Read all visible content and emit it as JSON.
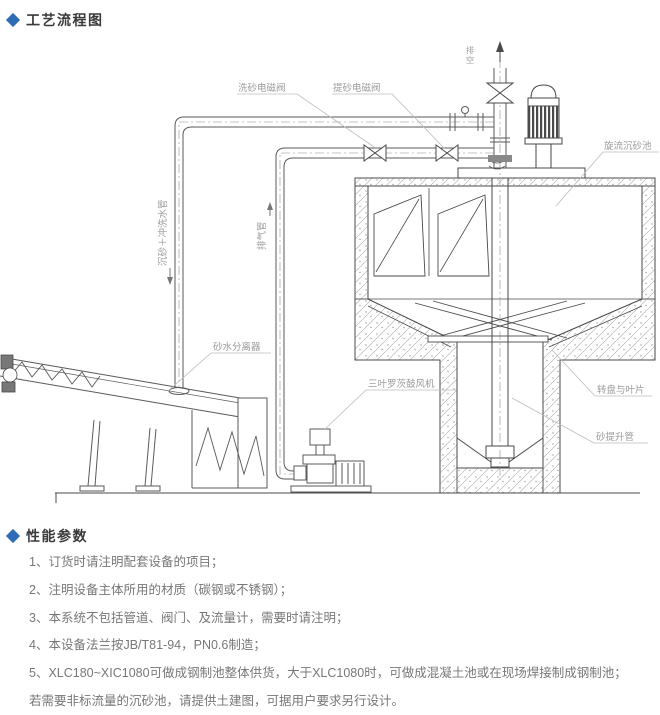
{
  "page": {
    "section1_title": "工艺流程图",
    "section2_title": "性能参数",
    "accent_color": "#2e6cb5"
  },
  "diagram": {
    "labels": {
      "wash_valve": "洗砂电磁阀",
      "lift_valve": "提砂电磁阀",
      "vent": "排空",
      "cyclone_tank": "旋流沉砂池",
      "sand_water_pipe": "沉砂＋冲洗水管",
      "exhaust_pipe": "排气管",
      "separator": "砂水分离器",
      "blower": "三叶罗茨鼓风机",
      "turntable": "转盘与叶片",
      "sand_lift_pipe": "砂提升管"
    }
  },
  "params": {
    "items": [
      "1、订货时请注明配套设备的项目；",
      "2、注明设备主体所用的材质（碳钢或不锈钢）；",
      "3、本系统不包括管道、阀门、及流量计，需要时请注明；",
      "4、本设备法兰按JB/T81-94，PN0.6制造；",
      "5、XLC180~XIC1080可做成钢制池整体供货，大于XLC1080时，可做成混凝土池或在现场焊接制成钢制池；",
      "若需要非标流量的沉砂池，请提供土建图，可据用户要求另行设计。"
    ]
  }
}
